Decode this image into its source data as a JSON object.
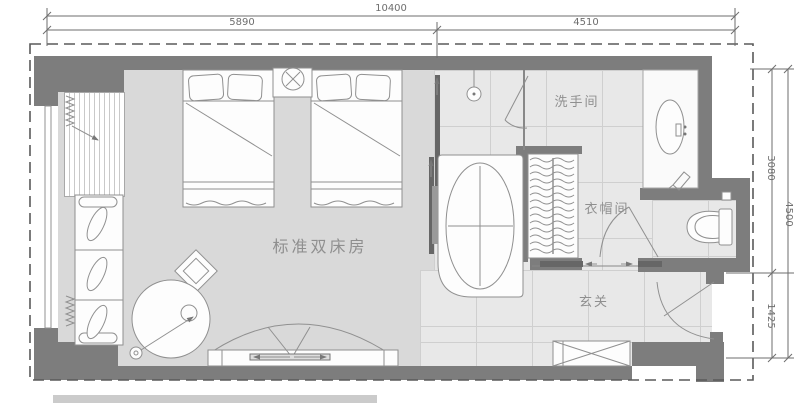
{
  "plan": {
    "title": "standard-twin-room-floor-plan",
    "room_labels": {
      "bedroom": "标准双床房",
      "bathroom": "洗手间",
      "cloakroom": "衣帽间",
      "entry": "玄关"
    },
    "dimensions": {
      "top_total": "10400",
      "top_left_segment": "5890",
      "top_right_segment": "4510",
      "right_upper_segment": "3080",
      "right_total": "4500",
      "right_lower_segment": "1425"
    },
    "colors": {
      "wall": "#7d7d7d",
      "dark": "#606060",
      "carpet": "#d9d9d9",
      "marble": "#e8e8e8",
      "tileline": "#cfcfcf",
      "fill": "#fdfdfd",
      "line": "#909090",
      "dim": "#6e6e6e",
      "label": "#8f8f8f",
      "boundary": "#5a5a5a"
    }
  }
}
